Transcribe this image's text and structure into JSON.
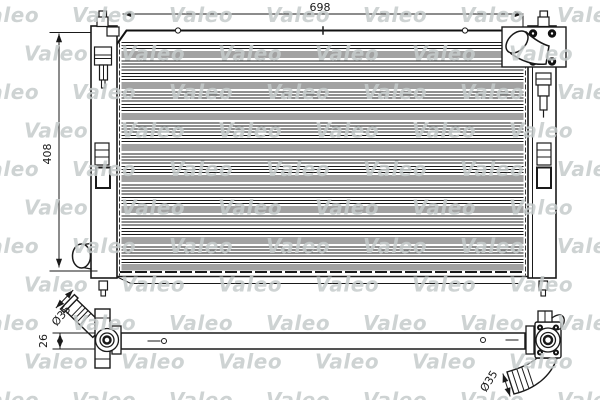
{
  "product_drawing": {
    "watermark": "Valeo",
    "dimensions": {
      "overall_width": "698",
      "overall_height": "408",
      "crossmember_depth": "26",
      "outlet_pipe_diameter": "Ø35",
      "inlet_pipe_diameter": "Ø35"
    },
    "colors": {
      "line": "#1a1a1a",
      "fin_band": "#a2a2a2",
      "watermark": "#c6cbcb",
      "background": "#ffffff"
    }
  }
}
